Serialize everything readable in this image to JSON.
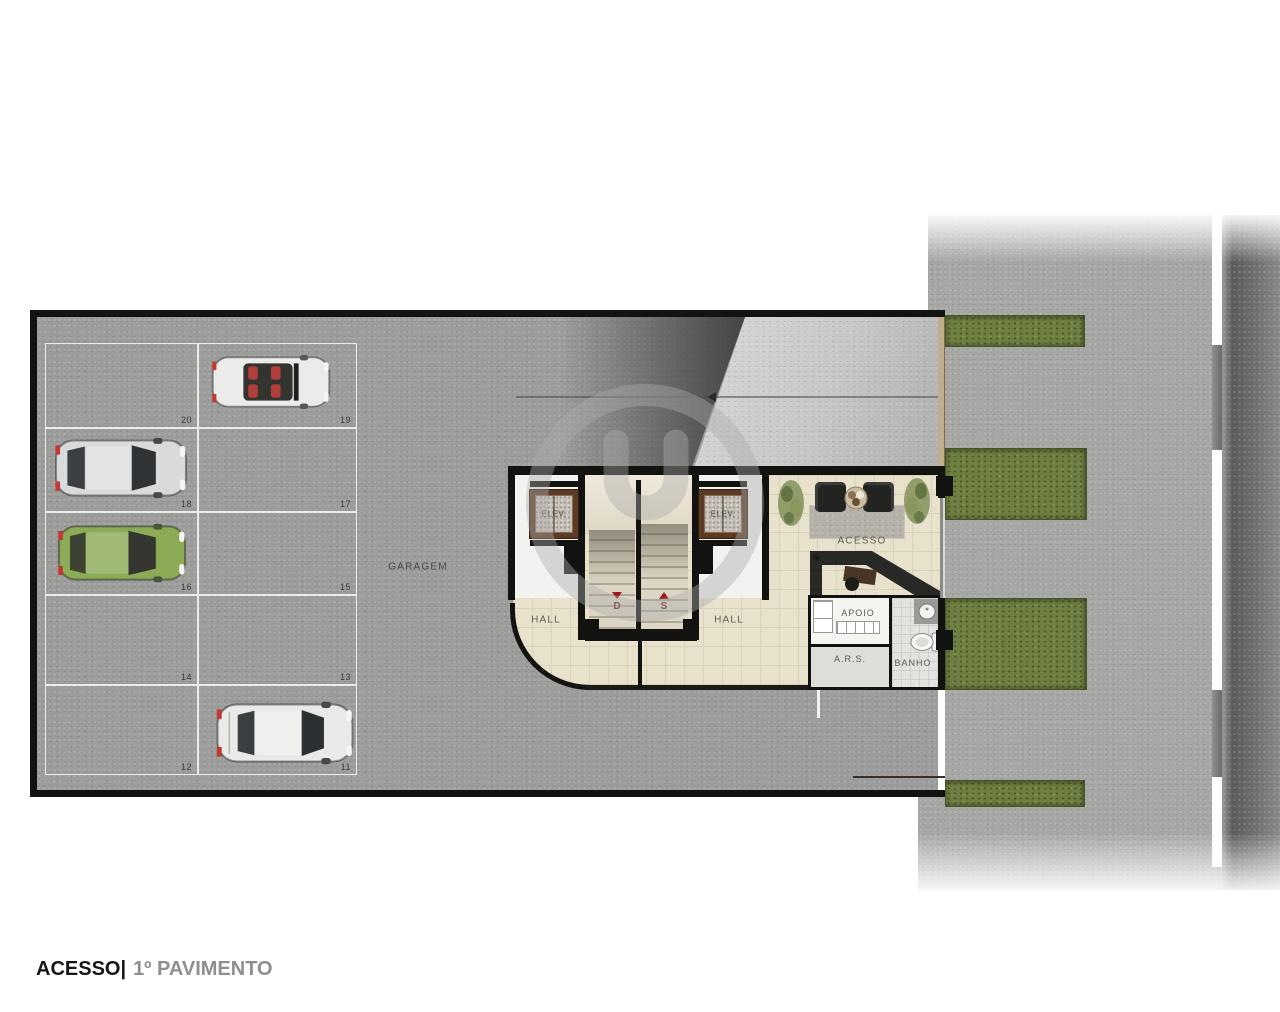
{
  "caption": {
    "title": "ACESSO|",
    "subtitle": "1º PAVIMENTO"
  },
  "plan": {
    "garage_label": "GARAGEM",
    "hall_left": "HALL",
    "hall_right": "HALL",
    "elevator_left": "ELEV.",
    "elevator_right": "ELEV.",
    "stair_down": "D",
    "stair_up": "S",
    "access_label": "ACESSO",
    "apoio_label": "APOIO",
    "ars_label": "A.R.S.",
    "banho_label": "BANHO"
  },
  "garage": {
    "spaces": [
      {
        "number": "20",
        "row": 0,
        "col": "left",
        "occupied": false
      },
      {
        "number": "19",
        "row": 0,
        "col": "right",
        "occupied": true
      },
      {
        "number": "18",
        "row": 1,
        "col": "left",
        "occupied": true
      },
      {
        "number": "17",
        "row": 1,
        "col": "right",
        "occupied": false
      },
      {
        "number": "16",
        "row": 2,
        "col": "left",
        "occupied": true
      },
      {
        "number": "15",
        "row": 2,
        "col": "right",
        "occupied": false
      },
      {
        "number": "14",
        "row": 3,
        "col": "left",
        "occupied": false
      },
      {
        "number": "13",
        "row": 3,
        "col": "right",
        "occupied": false
      },
      {
        "number": "12",
        "row": 4,
        "col": "left",
        "occupied": false
      },
      {
        "number": "11",
        "row": 4,
        "col": "right",
        "occupied": true
      }
    ]
  },
  "cars": [
    {
      "space": "19",
      "type": "convertible",
      "body_color": "#ebebe9",
      "glass_color": "#33332f",
      "seat_color": "#b23f3c"
    },
    {
      "space": "18",
      "type": "hatchback",
      "body_color": "#d8dadc",
      "glass_color": "#2f3336"
    },
    {
      "space": "16",
      "type": "hatchback",
      "body_color": "#8cab57",
      "glass_color": "#34362f"
    },
    {
      "space": "11",
      "type": "sedan",
      "body_color": "#e9e9e7",
      "glass_color": "#2b3033"
    }
  ],
  "colors": {
    "garage_floor": "#9c9c9a",
    "hall_floor": "#e8e1cc",
    "grass": "#6f7f42",
    "sidewalk": "#a6a6a4",
    "street": "#6e6e6c",
    "accent_red": "#9a1c1c",
    "elevator_frame": "#5b3b26",
    "building_outline": "#121210"
  }
}
